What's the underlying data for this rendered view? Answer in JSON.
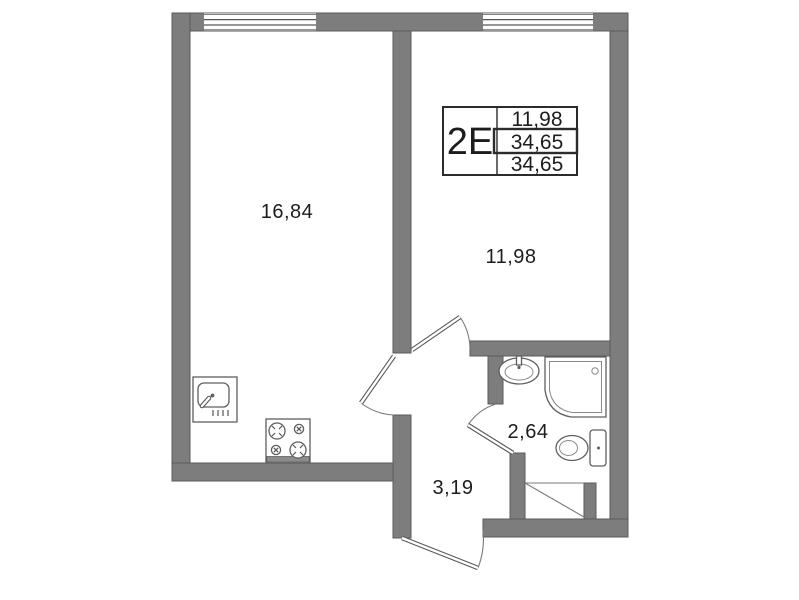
{
  "plan": {
    "info_box": {
      "type_label": "2Е",
      "rows": [
        "11,98",
        "34,65",
        "34,65"
      ]
    },
    "rooms": {
      "living_kitchen": {
        "area": "16,84"
      },
      "bedroom": {
        "area": "11,98"
      },
      "bathroom": {
        "area": "2,64"
      },
      "hallway": {
        "area": "3,19"
      }
    },
    "fixtures": [
      "kitchen-sink-icon",
      "stove-icon",
      "bath-sink-icon",
      "shower-icon",
      "toilet-icon"
    ],
    "colors": {
      "wall": "#7d7d7d",
      "wall_outline": "#5a5a5a",
      "line": "#565656",
      "text": "#1d1d1d",
      "background": "#ffffff"
    }
  }
}
